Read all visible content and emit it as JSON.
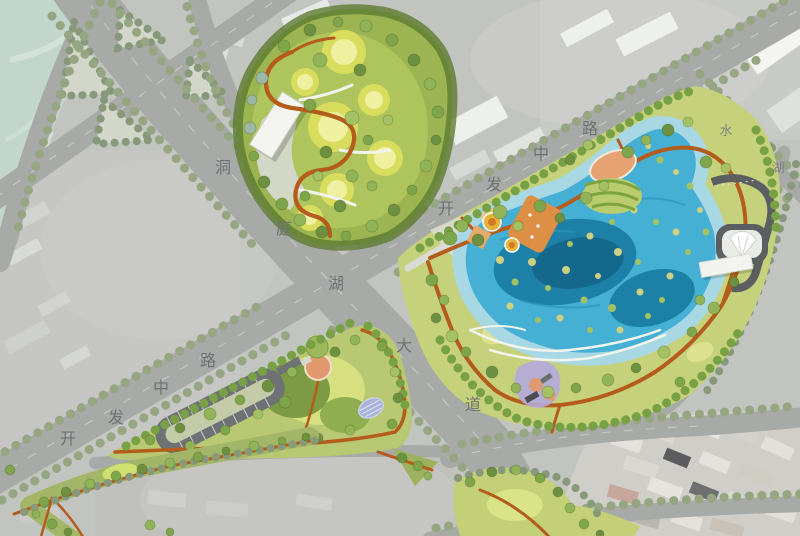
{
  "map": {
    "kind": "landscape-master-plan",
    "road_labels": {
      "dongting_lake_avenue": {
        "name": "洞庭湖大道",
        "chars": [
          "洞",
          "庭",
          "湖",
          "大",
          "道"
        ]
      },
      "kaifa_middle_road_ne": {
        "name": "开发中路",
        "chars": [
          "开",
          "发",
          "中",
          "路"
        ]
      },
      "kaifa_middle_road_sw": {
        "name": "开发中路",
        "chars": [
          "开",
          "发",
          "中",
          "路"
        ]
      },
      "shuihu_road_partial": {
        "name": "水湖",
        "chars": [
          "水",
          "湖"
        ]
      }
    },
    "palette": {
      "road_gray": "#a8aaa8",
      "street_tree_green": "#96a682",
      "park_green": "#9cb452",
      "meadow_yellow": "#e9e05e",
      "lake_shallow": "#a8d8e4",
      "lake_blue": "#45b0d4",
      "lake_deep": "#1d80a6",
      "trail_orange": "#b45c1c",
      "plaza_orange": "#dc8f45",
      "plaza_salmon": "#e2996e",
      "pool_lavender": "#a9b3da",
      "building_white": "#f3f4f0",
      "building_dark": "#56585a",
      "label_gray": "#6c7272"
    }
  }
}
